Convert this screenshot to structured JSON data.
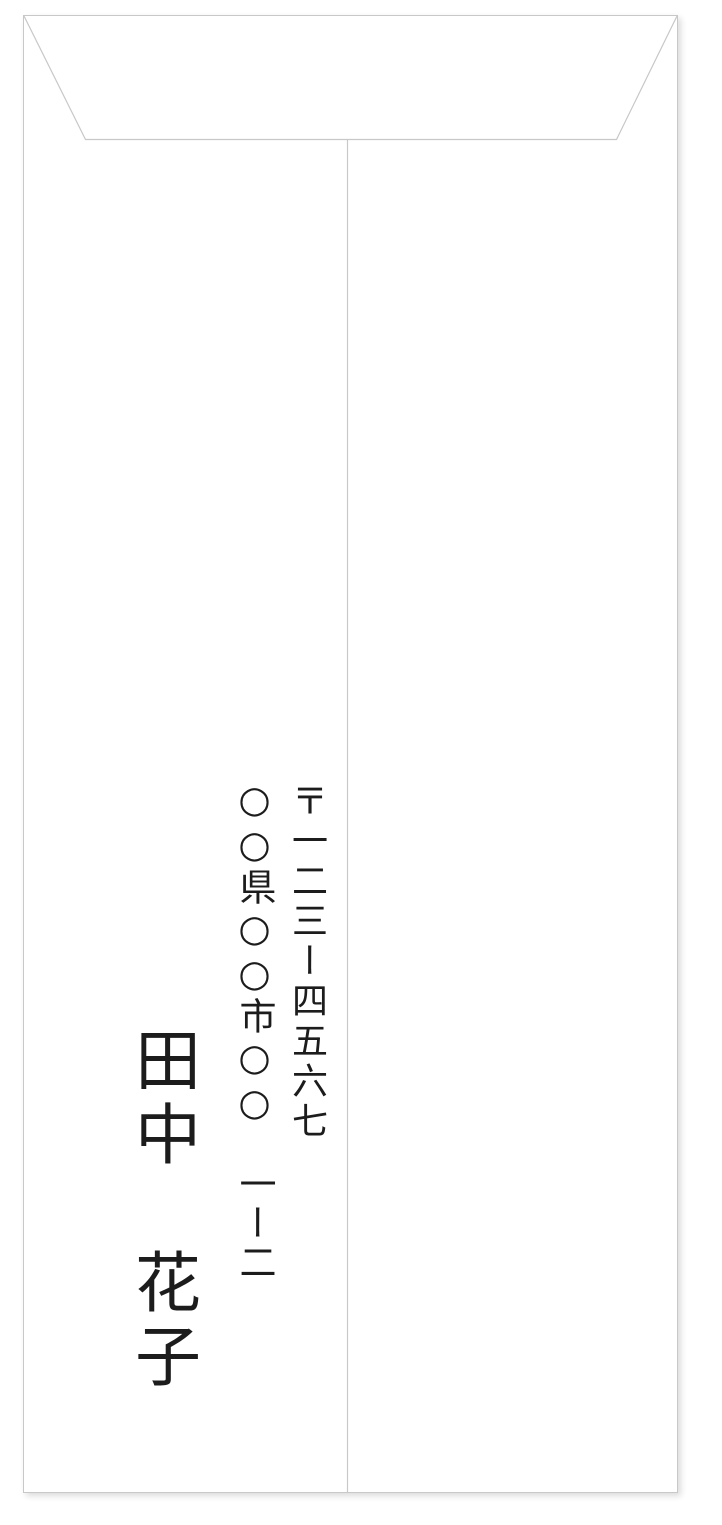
{
  "envelope": {
    "sender": {
      "postal_code": "〒一二三ー四五六七",
      "address": "○○県○○市○○　一ー二",
      "name": "田中　花子"
    },
    "colors": {
      "paper": "#ffffff",
      "outline": "#c8c8c8",
      "text": "#1c1c1c"
    }
  }
}
